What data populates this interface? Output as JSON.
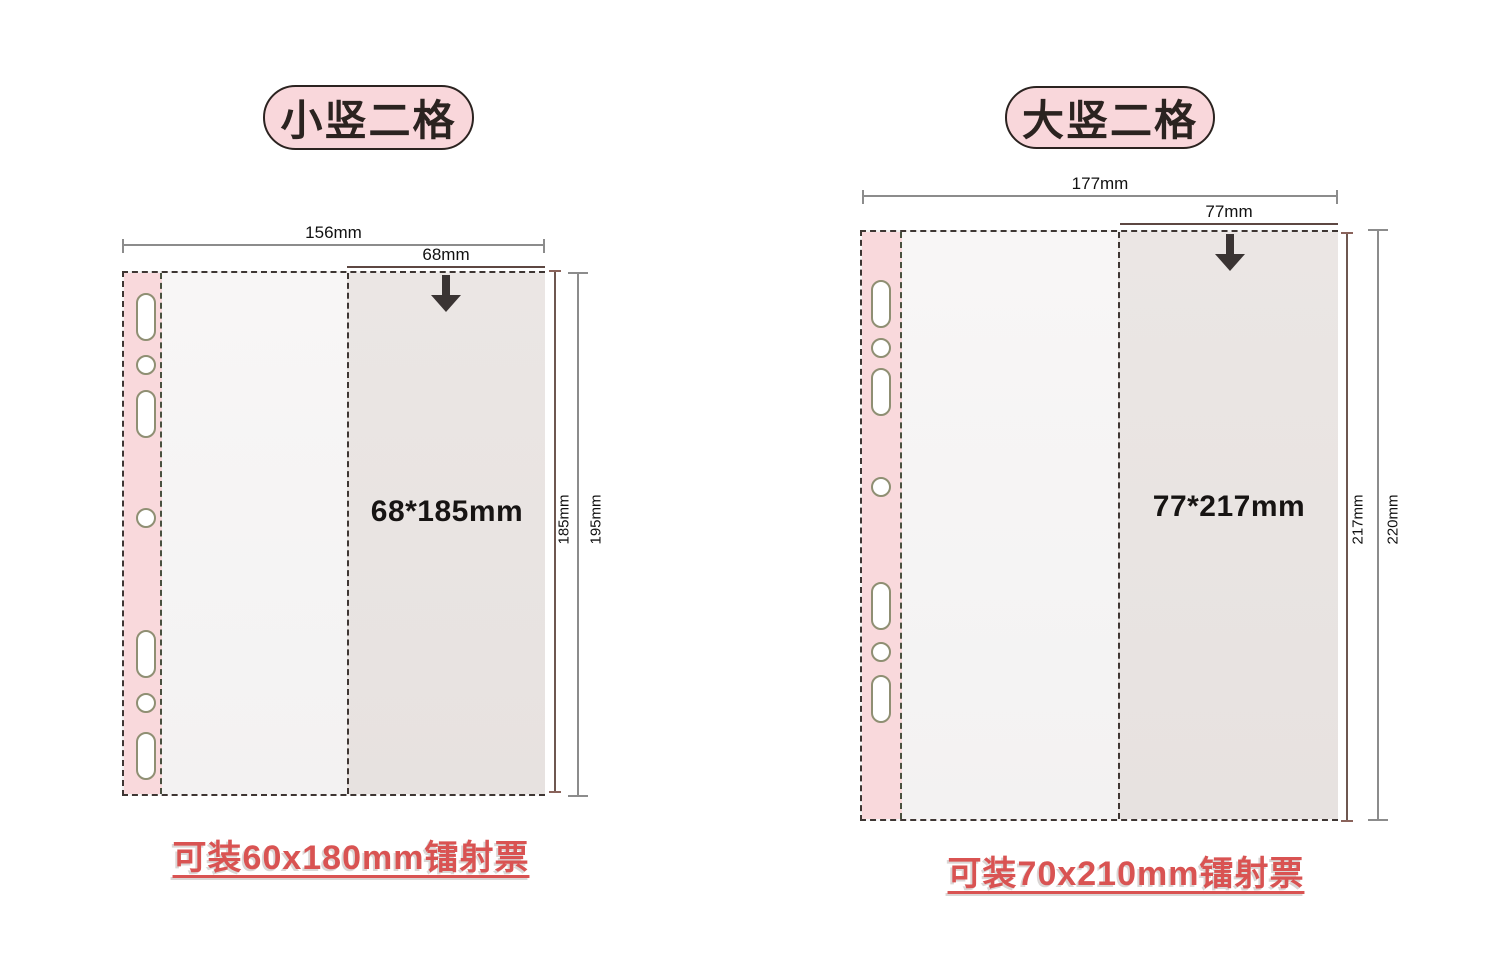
{
  "panels": [
    {
      "badge": "小竖二格",
      "outer_width_label": "156mm",
      "pocket_width_label": "68mm",
      "pocket_size_label": "68*185mm",
      "pocket_height_label": "185mm",
      "outer_height_label": "195mm",
      "caption": "可装60x180mm镭射票"
    },
    {
      "badge": "大竖二格",
      "outer_width_label": "177mm",
      "pocket_width_label": "77mm",
      "pocket_size_label": "77*217mm",
      "pocket_height_label": "217mm",
      "outer_height_label": "220mm",
      "caption": "可装70x210mm镭射票"
    }
  ],
  "icons": {
    "pocket_insert_arrow": "down-arrow-icon",
    "binder_hole_oblong": "oblong-binder-hole",
    "binder_hole_round": "round-binder-hole"
  },
  "colors": {
    "badge_fill": "#f9d7db",
    "badge_border": "#2b2320",
    "spine_pink": "#f9d9dc",
    "page_fill": "#f7f5f5",
    "pocket_fill": "#eae5e3",
    "dashed_border": "#3e3633",
    "dimension_gray": "#8c8c8c",
    "dimension_brown": "#5d4742",
    "arrow_dark": "#3a3433",
    "caption_red": "#d95352",
    "hole_outline": "#8f8f73"
  }
}
